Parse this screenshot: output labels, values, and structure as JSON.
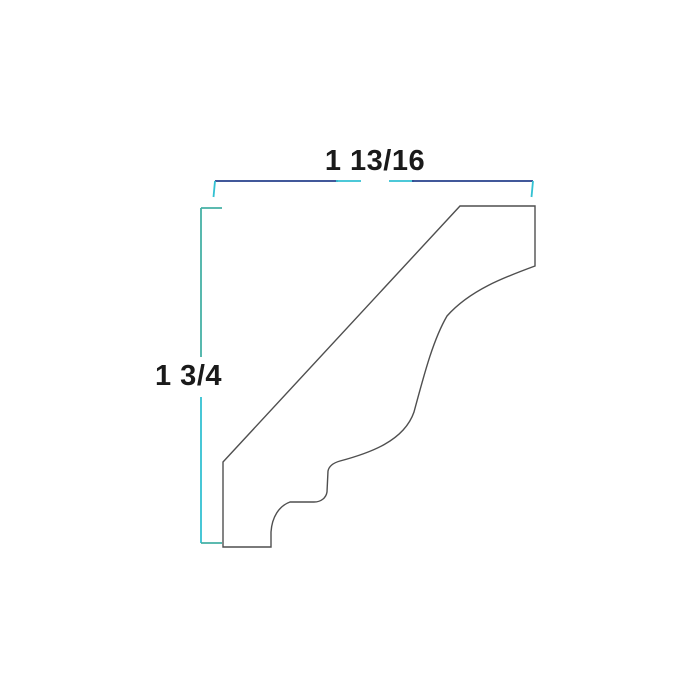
{
  "diagram": {
    "name": "crown-molding-profile-drawing",
    "background": "#ffffff",
    "labels": {
      "width": "1 13/16",
      "height": "1 3/4"
    },
    "colors": {
      "navy": "#26418c",
      "cyan": "#33c1d2",
      "teal": "#45b1a5",
      "profile": "#4f4f4f",
      "text": "#1a1a1a"
    },
    "paths": {
      "profile": "M223 462 L460 206 L535 206 L535 266 C505 277 470 290 447 316 C433 340 424 375 414 412 C404 441 370 453 340 461 C333 463 329 466 328 471 L327 492 C326 498 321 502 314 502 L290 502 C279 506 272 517 271 532 L271 547 L223 547 Z",
      "top_dim_left": "M215 181 L338 181",
      "top_dim_left_end": "M336 181 L361 181",
      "top_dim_right_end": "M389 181 L414 181",
      "top_dim_right": "M412 181 L533 181",
      "top_tick_left": "M215 181 L213.5 197",
      "top_tick_right": "M533 181 L531.5 197",
      "left_dim_top": "M201 208 L201 357",
      "left_dim_bottom": "M201 397 L201 543",
      "left_tick_top": "M201 208 L222 208",
      "left_tick_bottom": "M201 543 L222 543"
    }
  }
}
